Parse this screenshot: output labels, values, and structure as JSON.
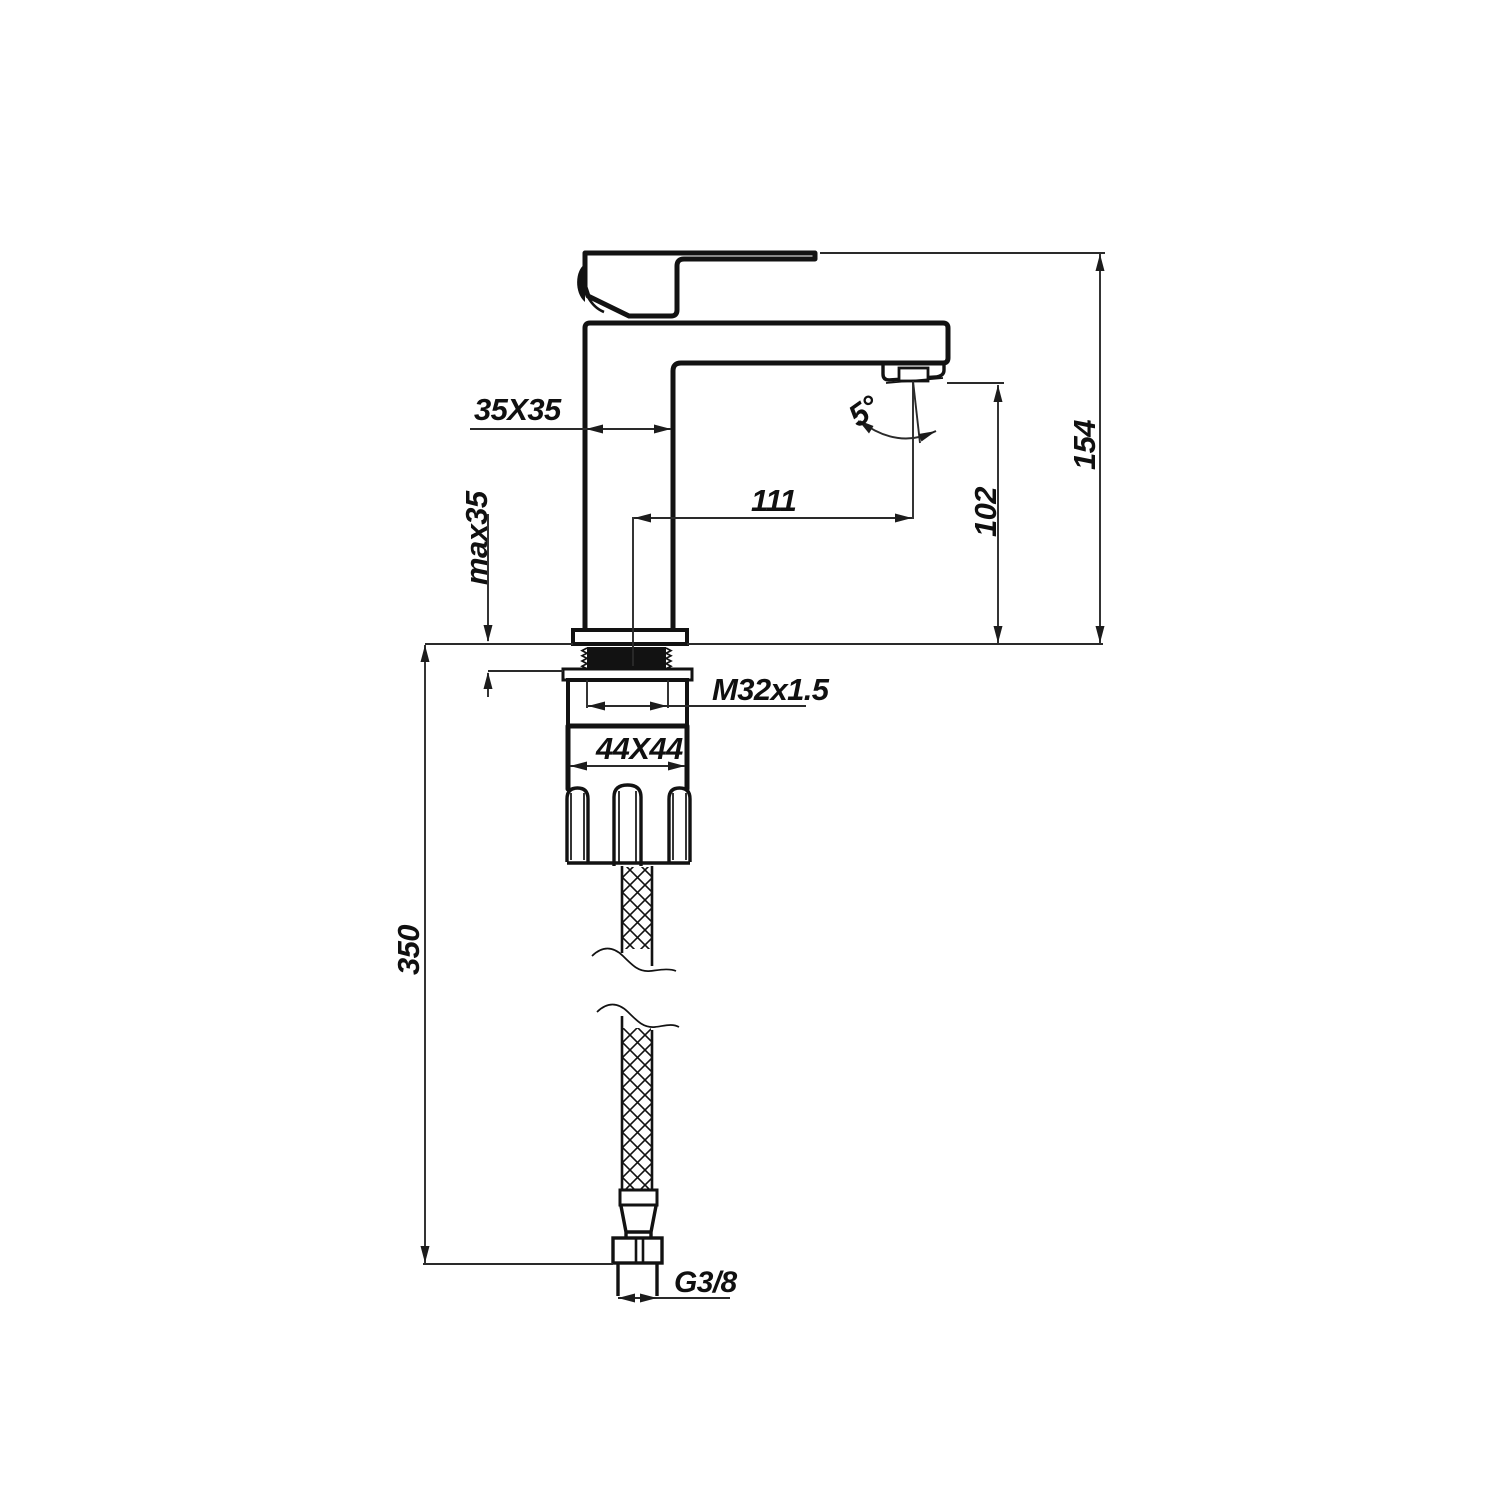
{
  "canvas": {
    "background": "#ffffff",
    "line_color": "#121212"
  },
  "labels": {
    "body_section": "35X35",
    "max_mounting_thickness": "max35",
    "spout_reach": "111",
    "spout_angle": "5°",
    "outlet_height": "102",
    "overall_height": "154",
    "shank_thread": "M32x1.5",
    "base_section": "44X44",
    "hose_length": "350",
    "inlet_thread": "G3/8"
  }
}
